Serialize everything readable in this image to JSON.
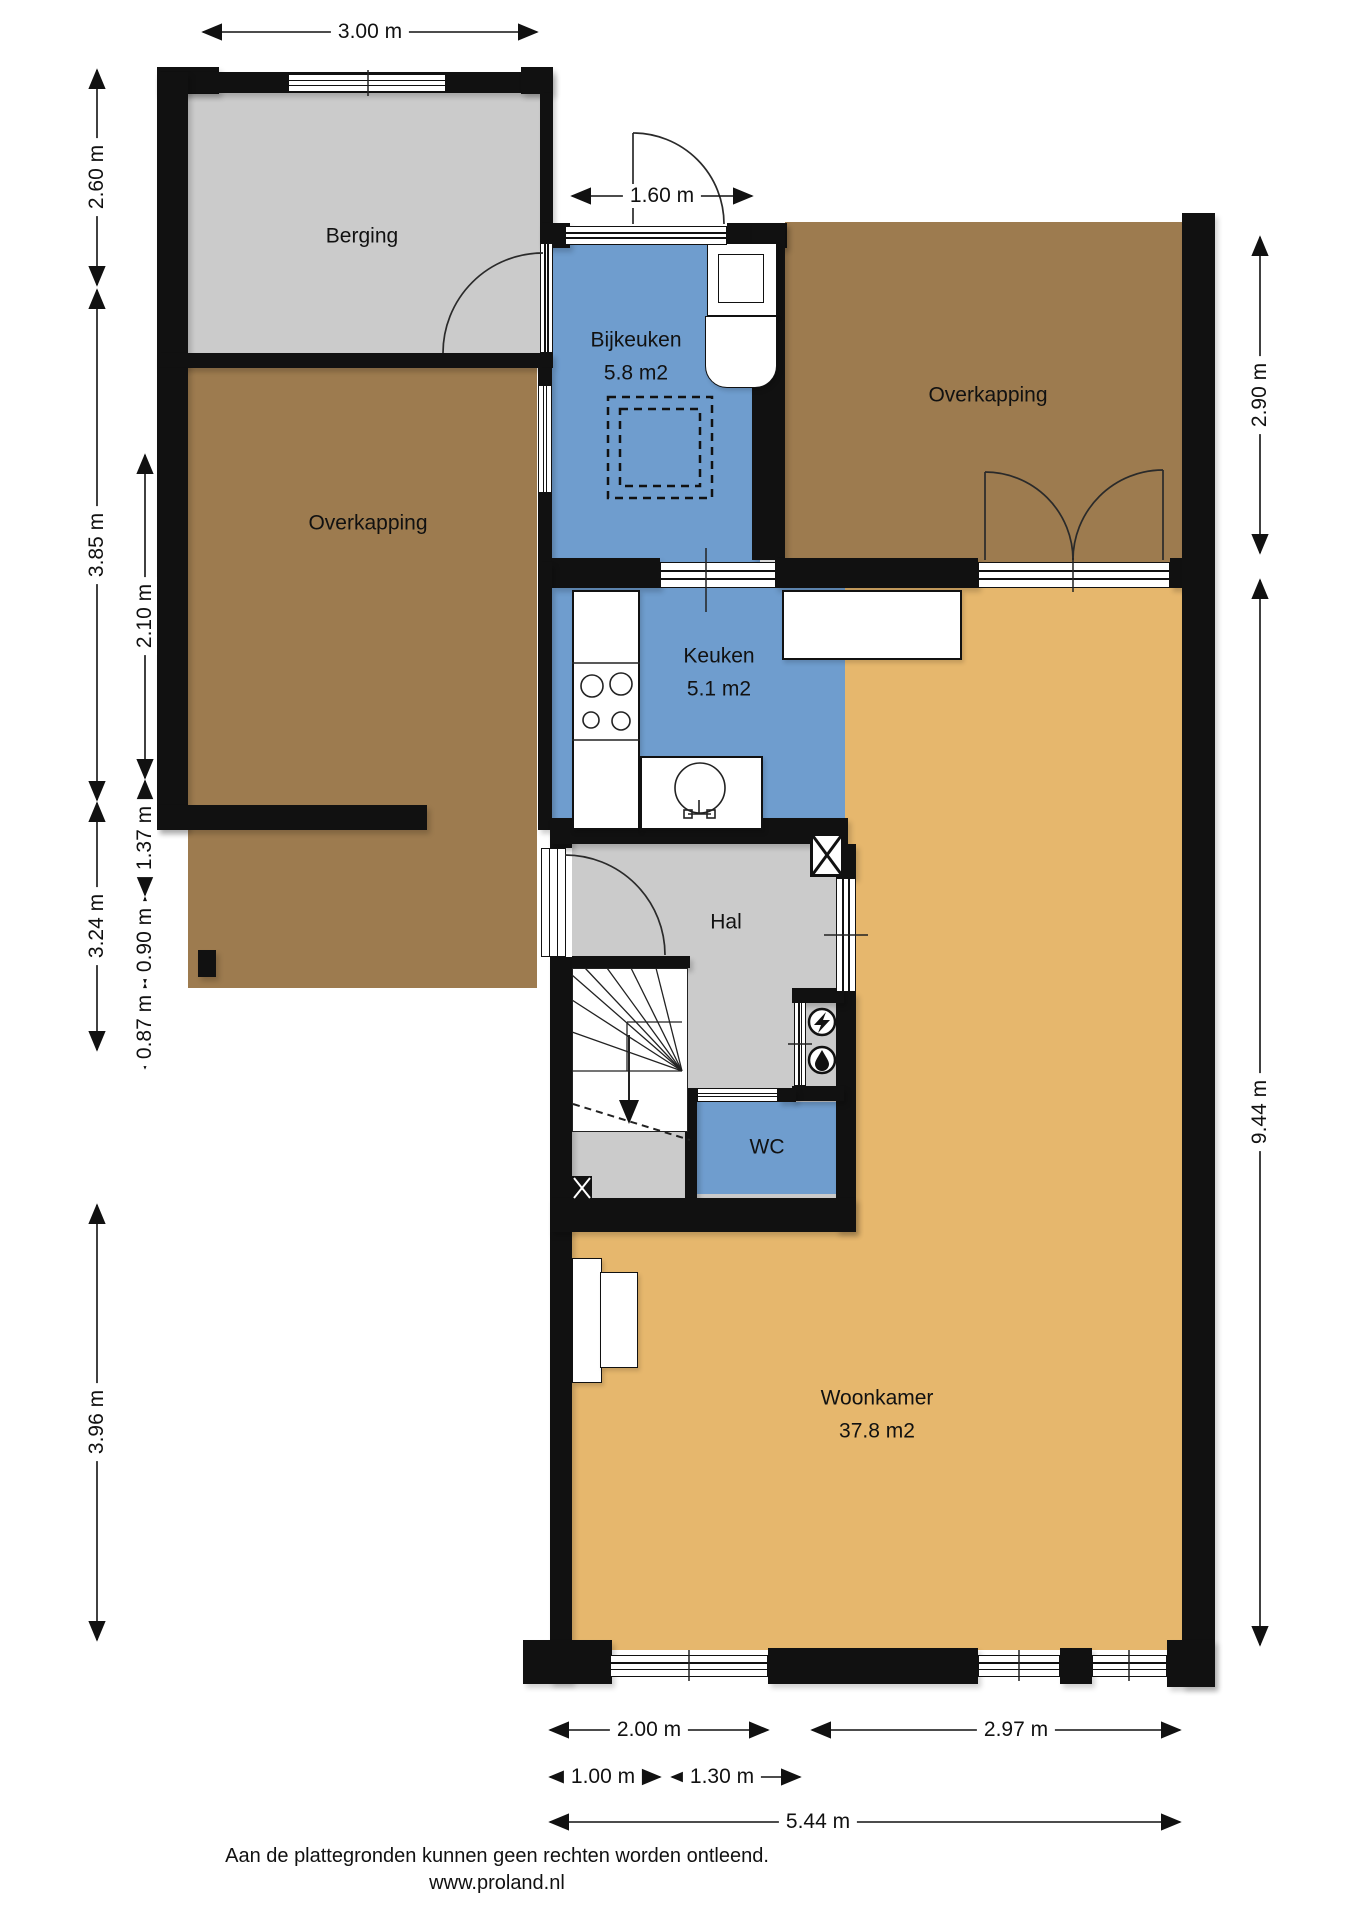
{
  "title": "Plattegrond begane grond",
  "colors": {
    "wall": "#111111",
    "floor_gray": "#cbcbcb",
    "floor_brown": "#9d7b4f",
    "floor_blue": "#6f9dce",
    "floor_tan": "#e6b76d",
    "line": "#222222",
    "background": "#ffffff"
  },
  "rooms": {
    "berging": {
      "label": "Berging"
    },
    "overkapping_left": {
      "label": "Overkapping"
    },
    "overkapping_right": {
      "label": "Overkapping"
    },
    "bijkeuken": {
      "label": "Bijkeuken",
      "area": "5.8 m2"
    },
    "keuken": {
      "label": "Keuken",
      "area": "5.1 m2"
    },
    "hal": {
      "label": "Hal"
    },
    "wc": {
      "label": "WC"
    },
    "woonkamer": {
      "label": "Woonkamer",
      "area": "37.8 m2"
    }
  },
  "dimensions": {
    "top_width": "3.00 m",
    "entry_width": "1.60 m",
    "left_outer": [
      "2.60 m",
      "3.85 m",
      "3.24 m",
      "3.96 m"
    ],
    "left_inner": [
      "2.10 m",
      "1.37 m",
      "0.90 m",
      "0.87 m"
    ],
    "right_upper": "2.90 m",
    "right_lower": "9.44 m",
    "bottom_left": "2.00 m",
    "bottom_right": "2.97 m",
    "bottom_sub_left": "1.00 m",
    "bottom_sub_right": "1.30 m",
    "bottom_total": "5.44 m"
  },
  "icons": {
    "electricity_meter": "lightning-bolt",
    "water_meter": "water-drop",
    "duct": "crossed-box"
  },
  "footer": {
    "disclaimer": "Aan de plattegronden kunnen geen rechten worden ontleend.",
    "website": "www.proland.nl"
  }
}
